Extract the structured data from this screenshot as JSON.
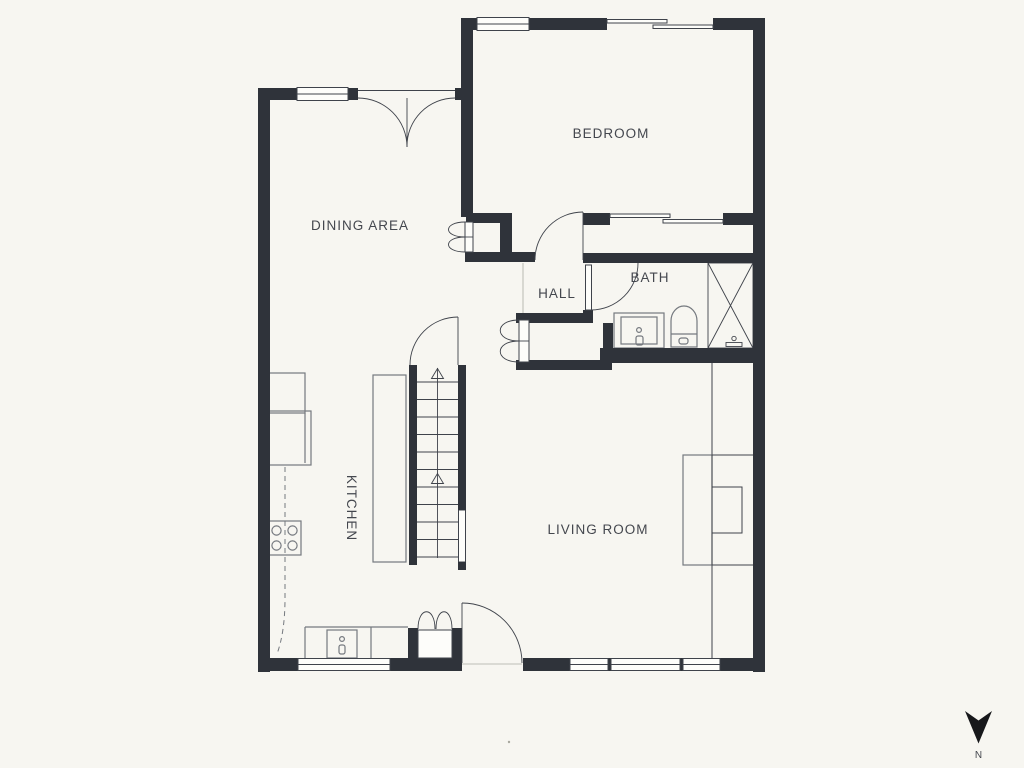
{
  "plan": {
    "rooms": {
      "bedroom": {
        "label": "BEDROOM"
      },
      "dining": {
        "label": "DINING AREA"
      },
      "hall": {
        "label": "HALL"
      },
      "bath": {
        "label": "BATH"
      },
      "kitchen": {
        "label": "KITCHEN"
      },
      "living": {
        "label": "LIVING ROOM"
      }
    },
    "compass": {
      "north_label": "N"
    }
  },
  "colors": {
    "background": "#f7f6f1",
    "wall": "#2f333a",
    "line": "#3f434b",
    "fixture": "#75797f",
    "text": "#44474e",
    "compass": "#17181b",
    "window_fill": "#fdfdfa"
  }
}
